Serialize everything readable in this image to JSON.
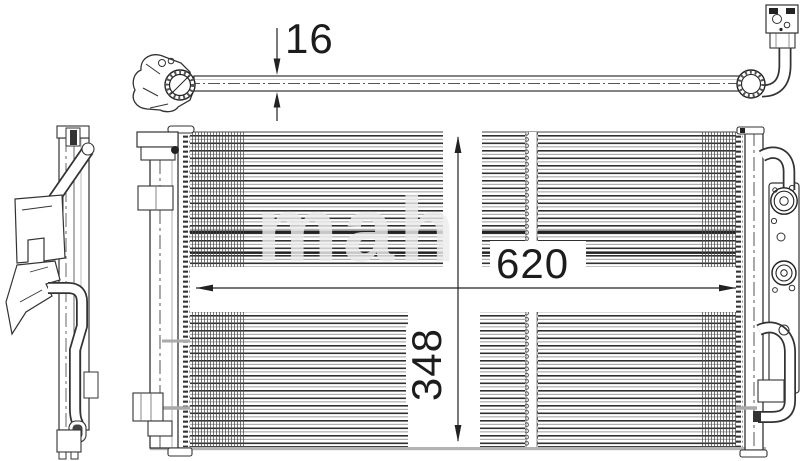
{
  "dimensions": {
    "depth_mm": "16",
    "width_mm": "620",
    "height_mm": "348"
  },
  "watermark": {
    "text": "mah"
  },
  "colors": {
    "line_dark": "#2f2f2f",
    "line_grey": "#a6a6a6",
    "dimension_text": "#1c1c1c",
    "watermark_grey": "#ececec",
    "background": "#ffffff"
  }
}
